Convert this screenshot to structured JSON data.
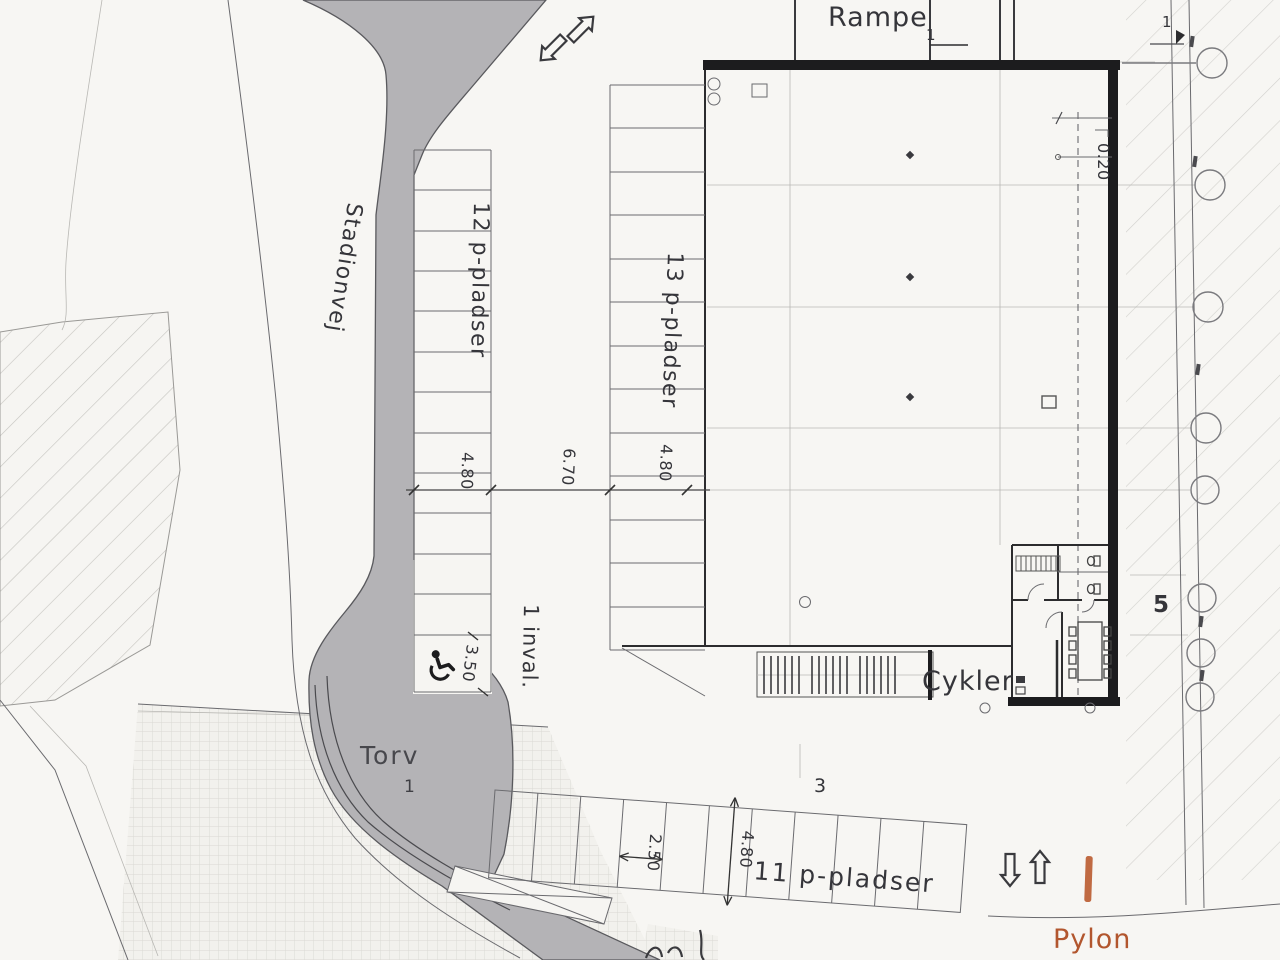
{
  "labels": {
    "street": "Stadionvej",
    "ramp": "Rampe",
    "ramp_marker": "1",
    "corner_marker": "1",
    "row_west": "12 p-pladser",
    "row_mid": "13 p-pladser",
    "row_south": "11 p-pladser",
    "disabled": "1 inval.",
    "plaza": "Torv",
    "plaza_number": "1",
    "bikes": "Cykler",
    "pylon": "Pylon",
    "area_number": "3",
    "grid_number": "5"
  },
  "dimensions": {
    "stall_depth_west": "4.80",
    "aisle_width": "6.70",
    "stall_depth_mid": "4.80",
    "disabled_width": "3.50",
    "stall_width_south": "2.50",
    "stall_depth_south": "4.80",
    "wall_offset": "0.20"
  },
  "icons": [
    "arrow-ne-icon",
    "arrow-sw-icon",
    "arrow-up-icon",
    "arrow-down-icon",
    "wheelchair-icon",
    "grid-bubble-icon",
    "pylon-bar-icon"
  ],
  "colors": {
    "surface_gray": "#b4b3b6",
    "pylon_orange": "#b2562e",
    "ink": "#35353a",
    "paper": "#f7f6f3"
  }
}
